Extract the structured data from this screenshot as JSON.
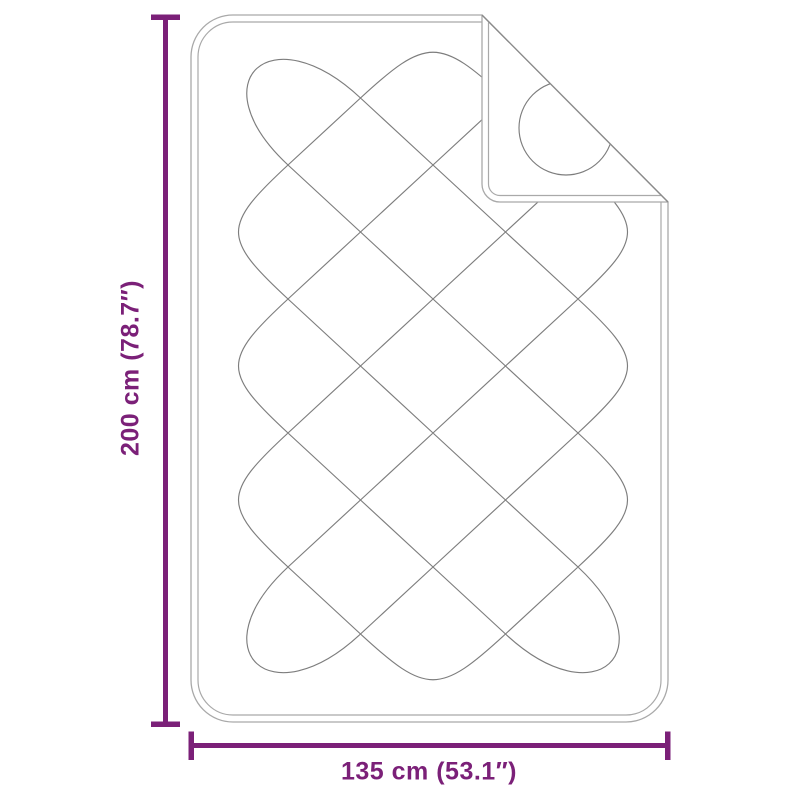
{
  "diagram": {
    "title": "quilted mattress protector dimension diagram",
    "vertical_dimension_label": "200 cm (78.7″)",
    "horizontal_dimension_label": "135 cm (53.1″)"
  },
  "colors": {
    "dimension_accent": "#7b2078",
    "blanket_outline": "#a9a9a9",
    "quilt_pattern": "#7d7d7d",
    "fold_crease": "#8a8a8a",
    "background": "#ffffff"
  }
}
